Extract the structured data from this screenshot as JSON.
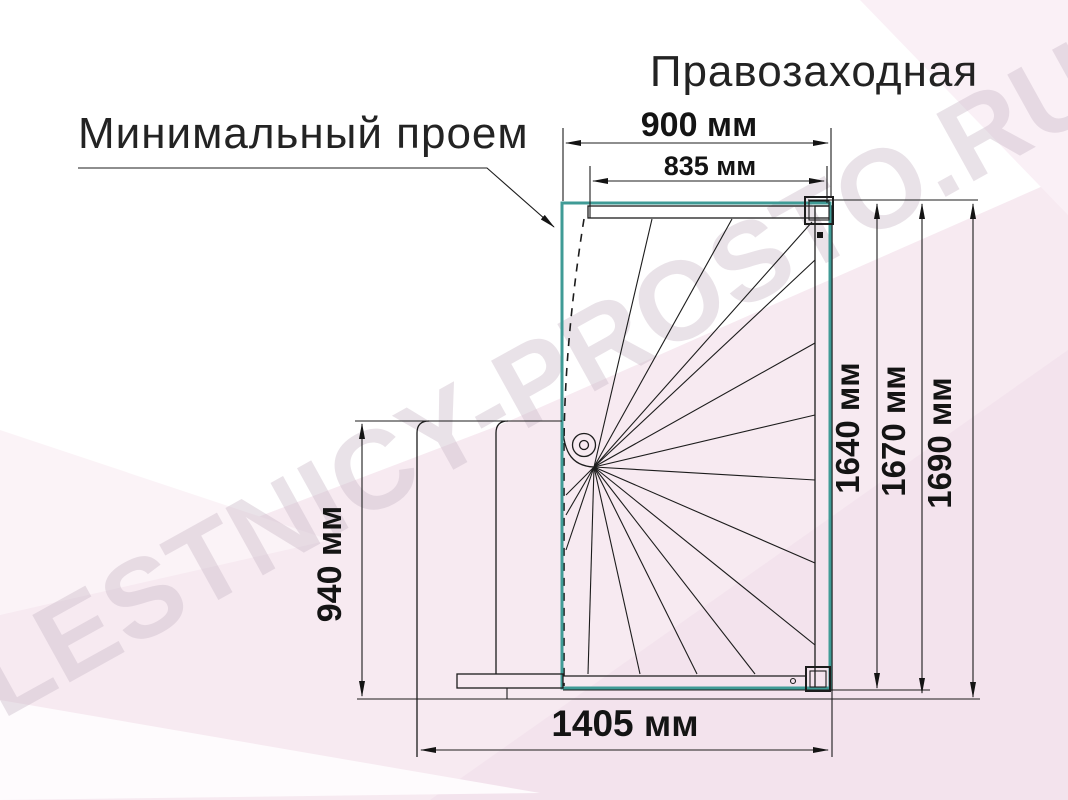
{
  "header": {
    "title": "Правозаходная"
  },
  "callout": {
    "label": "Минимальный проем"
  },
  "watermark": {
    "text": "LESTNICY-PROSTO.RU"
  },
  "dimensions": {
    "opening_width": "900 мм",
    "inner_width": "835 мм",
    "right_inner": "1640 мм",
    "right_middle": "1670 мм",
    "right_outer": "1690 мм",
    "left_height": "940 мм",
    "total_width": "1405 мм"
  },
  "colors": {
    "opening_outline": "#3F9B96",
    "drawing_line": "#1c1c1c",
    "watermark": "#cbbbc7",
    "background_tint": "#f7eaf1"
  }
}
